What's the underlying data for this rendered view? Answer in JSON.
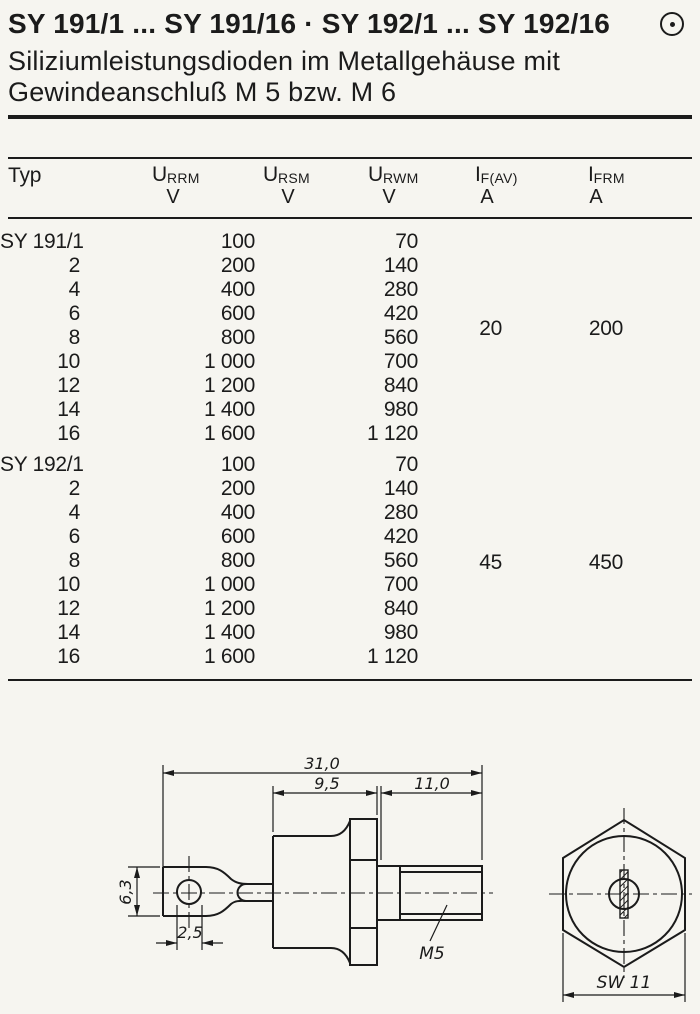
{
  "page": {
    "background": "#f6f5f0",
    "ink": "#1b1b1b"
  },
  "header": {
    "title": "SY 191/1 ... SY 191/16 · SY 192/1 ... SY 192/16",
    "subtitle_line1": "Siliziumleistungsdioden im Metallgehäuse mit",
    "subtitle_line2": "Gewindeanschluß M 5 bzw. M 6",
    "logo_icon": "circle-dot-icon"
  },
  "table": {
    "col_typ": "Typ",
    "columns": [
      {
        "sym": "U",
        "sub": "RRM",
        "unit": "V"
      },
      {
        "sym": "U",
        "sub": "RSM",
        "unit": "V"
      },
      {
        "sym": "U",
        "sub": "RWM",
        "unit": "V"
      },
      {
        "sym": "I",
        "sub": "F(AV)",
        "unit": "A"
      },
      {
        "sym": "I",
        "sub": "FRM",
        "unit": "A"
      }
    ],
    "sections": [
      {
        "if_av": "20",
        "ifrm": "200",
        "rows": [
          {
            "typ": "SY 191/1",
            "urrm": "100",
            "urwm": "70"
          },
          {
            "typ": "2",
            "urrm": "200",
            "urwm": "140"
          },
          {
            "typ": "4",
            "urrm": "400",
            "urwm": "280"
          },
          {
            "typ": "6",
            "urrm": "600",
            "urwm": "420"
          },
          {
            "typ": "8",
            "urrm": "800",
            "urwm": "560"
          },
          {
            "typ": "10",
            "urrm": "1 000",
            "urwm": "700"
          },
          {
            "typ": "12",
            "urrm": "1 200",
            "urwm": "840"
          },
          {
            "typ": "14",
            "urrm": "1 400",
            "urwm": "980"
          },
          {
            "typ": "16",
            "urrm": "1 600",
            "urwm": "1 120"
          }
        ]
      },
      {
        "if_av": "45",
        "ifrm": "450",
        "rows": [
          {
            "typ": "SY 192/1",
            "urrm": "100",
            "urwm": "70"
          },
          {
            "typ": "2",
            "urrm": "200",
            "urwm": "140"
          },
          {
            "typ": "4",
            "urrm": "400",
            "urwm": "280"
          },
          {
            "typ": "6",
            "urrm": "600",
            "urwm": "420"
          },
          {
            "typ": "8",
            "urrm": "800",
            "urwm": "560"
          },
          {
            "typ": "10",
            "urrm": "1 000",
            "urwm": "700"
          },
          {
            "typ": "12",
            "urrm": "1 200",
            "urwm": "840"
          },
          {
            "typ": "14",
            "urrm": "1 400",
            "urwm": "980"
          },
          {
            "typ": "16",
            "urrm": "1 600",
            "urwm": "1 120"
          }
        ]
      }
    ]
  },
  "drawing": {
    "side_view_dims": {
      "total_length": "31,0",
      "case_length": "9,5",
      "stud_length": "11,0",
      "lug_width": "6,3",
      "hole_dia": "2,5",
      "thread": "M5"
    },
    "end_view_dims": {
      "wrench_size": "SW 11"
    }
  }
}
